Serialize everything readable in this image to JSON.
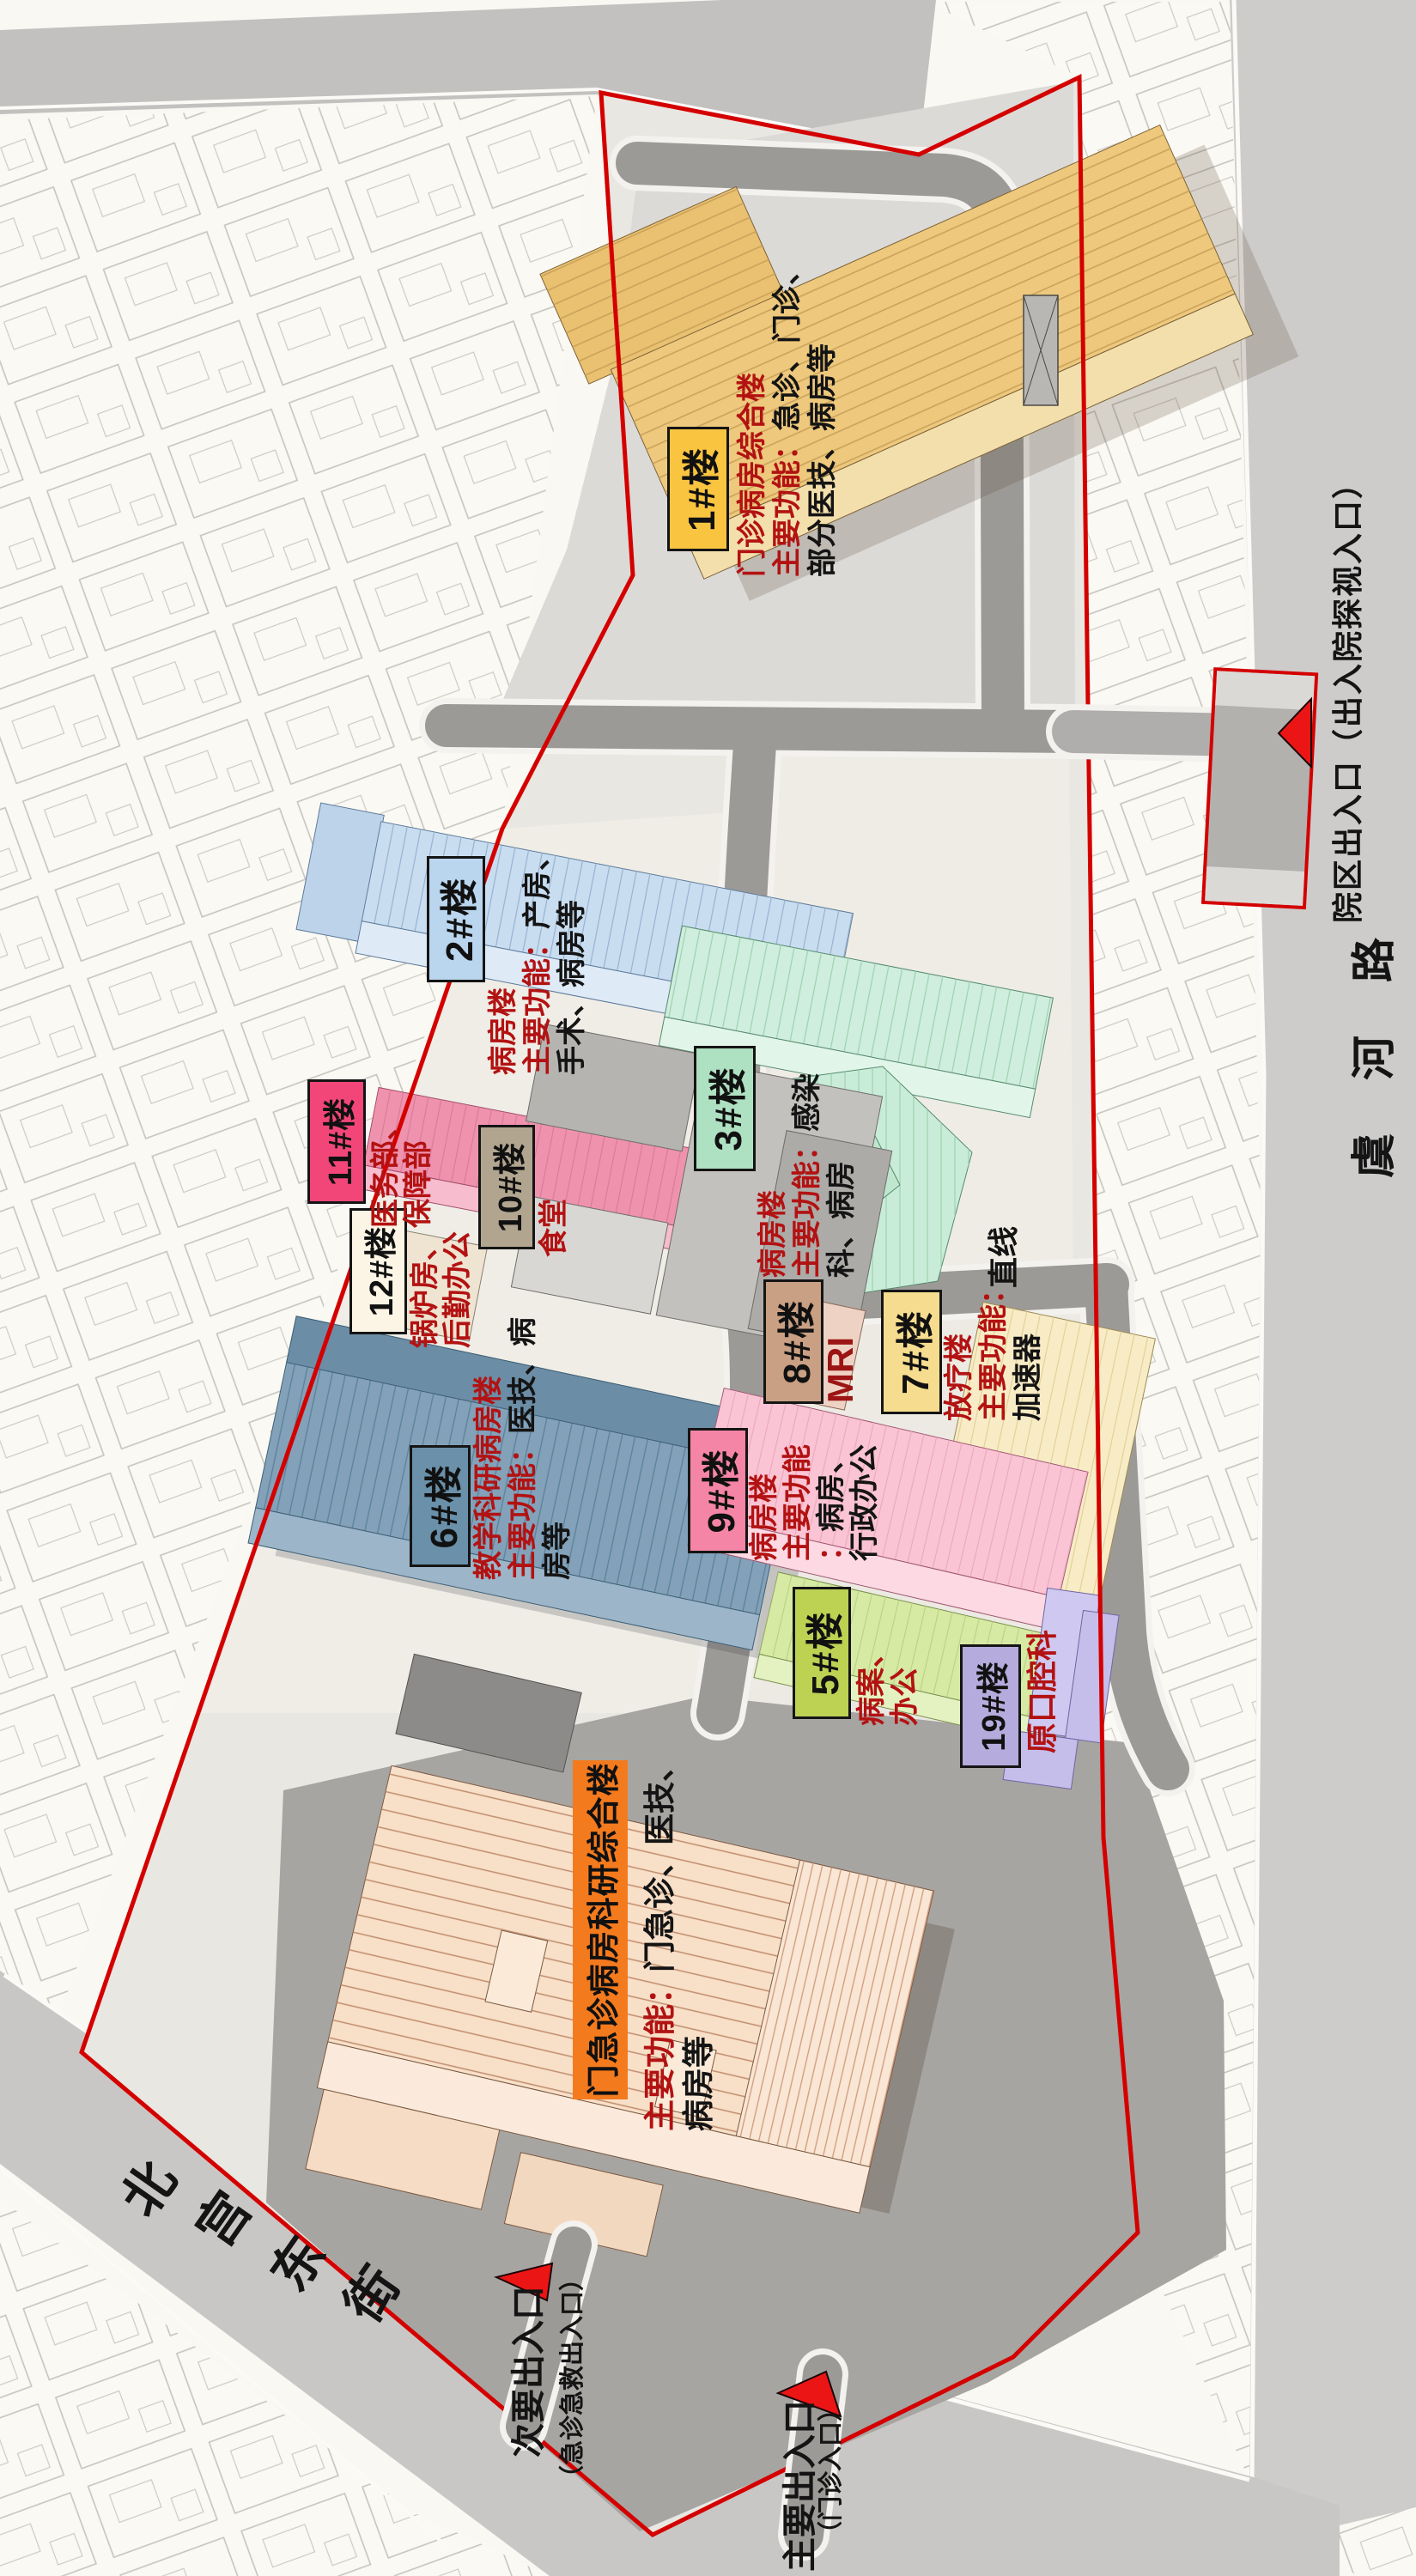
{
  "colors": {
    "boundary": "#d40000",
    "arrow": "#ec1515",
    "description_red": "#b31212",
    "label_text": "#111111"
  },
  "streets": {
    "east_name": "虞河路",
    "southwest_chars": [
      "北",
      "宫",
      "东",
      "街"
    ],
    "road_note": "直线"
  },
  "entrances": {
    "east_full": "院区出入口（出入院探视入口）",
    "main": "主要出入口",
    "main_sub": "（门诊入口）",
    "secondary": "次要出入口",
    "secondary_sub": "（急诊急救出入口）"
  },
  "buildings": {
    "b1": {
      "label": "1#楼",
      "color": "#f9c440",
      "name": "门诊病房综合楼",
      "func_prefix": "主要功能：",
      "func_a": "急诊、门诊、",
      "func_b": "部分医技、病房等"
    },
    "b2": {
      "label": "2#楼",
      "color": "#bad5ee",
      "name": "病房楼",
      "func_prefix": "主要功能：",
      "func_a": "产房、",
      "func_b": "手术、病房等"
    },
    "b3": {
      "label": "3#楼",
      "color": "#aee0c2",
      "name": "病房楼",
      "func_prefix": "主要功能：",
      "func_a": "感染",
      "func_b": "科、病房"
    },
    "b5": {
      "label": "5#楼",
      "color": "#bdd153",
      "desc_a": "病案、",
      "desc_b": "办公"
    },
    "b6": {
      "label": "6#楼",
      "color": "#6a90aa",
      "name": "教学科研病房楼",
      "func_prefix": "主要功能：",
      "func_a": "医技、病",
      "func_b": "房等"
    },
    "b7": {
      "label": "7#楼",
      "color": "#f6dc8e",
      "name": "放疗楼",
      "func_prefix": "主要功能：",
      "func_a": "加速器"
    },
    "b8": {
      "label": "8#楼",
      "color": "#c9a083",
      "desc": "MRI"
    },
    "b9": {
      "label": "9#楼",
      "color": "#f585a6",
      "name": "病房楼",
      "func_prefix": "主要功能",
      "colon": "：",
      "func_a": "病房、",
      "func_b": "行政办公"
    },
    "b10": {
      "label": "10#楼",
      "color": "#b2a590",
      "desc": "食堂"
    },
    "b11": {
      "label": "11#楼",
      "color": "#f24679",
      "desc_a": "医务部、",
      "desc_b": "保障部"
    },
    "b12": {
      "label": "12#楼",
      "color": "#fcf4e4",
      "desc_a": "锅炉房、",
      "desc_b": "后勤办公"
    },
    "b19": {
      "label": "19#楼",
      "color": "#b5abdc",
      "desc": "原口腔科"
    },
    "main_complex": {
      "banner": "门急诊病房科研综合楼",
      "banner_color": "#f47a1e",
      "func_prefix": "主要功能：",
      "func_a": "门急诊、医技、",
      "func_b": "病房等"
    }
  }
}
